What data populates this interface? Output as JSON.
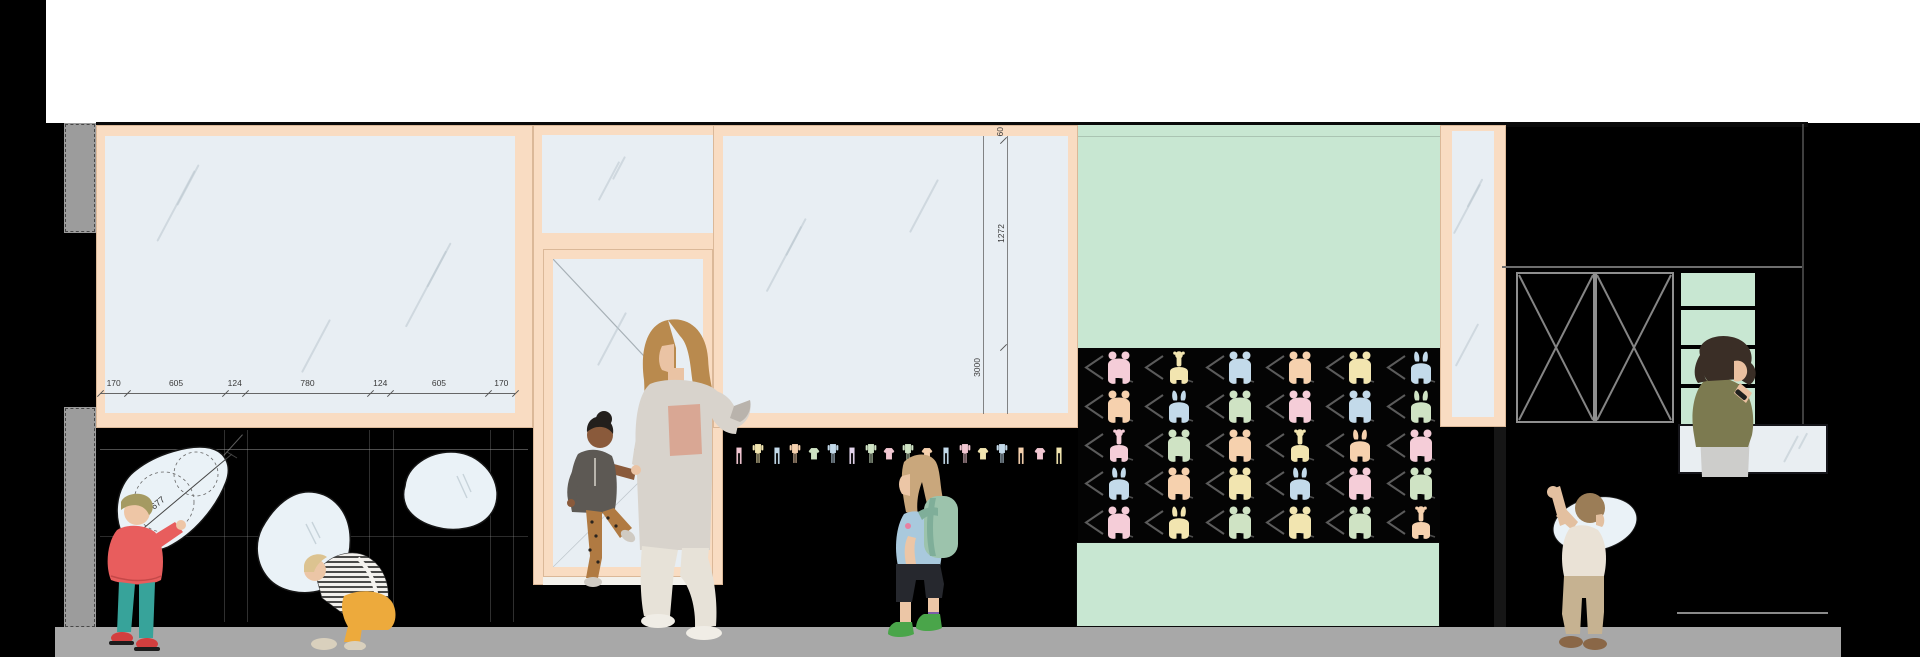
{
  "annotations": {
    "bottom_dims": [
      "170",
      "605",
      "124",
      "780",
      "124",
      "605",
      "170"
    ],
    "blob_dim": "677",
    "vert_dims": [
      "60",
      "1272",
      "3000"
    ]
  },
  "colors": {
    "frame": "#f9dcc2",
    "glass": "#e8eef3",
    "mint": "#c8e7d2",
    "sidewalk": "#a8a8a8",
    "pilaster": "#9c9c9c",
    "mirror": "#eaf2f7",
    "desk": "#e9eef2",
    "wall": "#000000",
    "annotation": "#444444",
    "chevron": "#6b6b6b"
  },
  "pattern_wall": {
    "rows": 5,
    "cols": 6,
    "cells": [
      {
        "c": "#f5cdd8",
        "v": "bear"
      },
      {
        "c": "#f2e5b0",
        "v": "giraffe"
      },
      {
        "c": "#c3daea",
        "v": "bear"
      },
      {
        "c": "#f6d1ae",
        "v": "bear"
      },
      {
        "c": "#f2e5b0",
        "v": "bear"
      },
      {
        "c": "#c3daea",
        "v": "bunny"
      },
      {
        "c": "#f6d1ae",
        "v": "bear"
      },
      {
        "c": "#c3daea",
        "v": "bunny"
      },
      {
        "c": "#cfe3c4",
        "v": "bear"
      },
      {
        "c": "#f5cdd8",
        "v": "bear"
      },
      {
        "c": "#c3daea",
        "v": "bear"
      },
      {
        "c": "#cfe3c4",
        "v": "bunny"
      },
      {
        "c": "#f5cdd8",
        "v": "giraffe"
      },
      {
        "c": "#cfe3c4",
        "v": "bear"
      },
      {
        "c": "#f6d1ae",
        "v": "bear"
      },
      {
        "c": "#f2e5b0",
        "v": "giraffe"
      },
      {
        "c": "#f6d1ae",
        "v": "bunny"
      },
      {
        "c": "#f5cdd8",
        "v": "bear"
      },
      {
        "c": "#c3daea",
        "v": "bunny"
      },
      {
        "c": "#f6d1ae",
        "v": "bear"
      },
      {
        "c": "#f2e5b0",
        "v": "bear"
      },
      {
        "c": "#c3daea",
        "v": "bunny"
      },
      {
        "c": "#f5cdd8",
        "v": "bear"
      },
      {
        "c": "#cfe3c4",
        "v": "bear"
      },
      {
        "c": "#f5cdd8",
        "v": "bear"
      },
      {
        "c": "#f2e5b0",
        "v": "bunny"
      },
      {
        "c": "#cfe3c4",
        "v": "bear"
      },
      {
        "c": "#f2e5b0",
        "v": "bear"
      },
      {
        "c": "#cfe3c4",
        "v": "bear"
      },
      {
        "c": "#f6d1ae",
        "v": "giraffe"
      }
    ]
  },
  "clothes_row": {
    "items": [
      {
        "c": "#f2c7d2",
        "v": "pants"
      },
      {
        "c": "#f2e5b0",
        "v": "romper"
      },
      {
        "c": "#c3daea",
        "v": "pants"
      },
      {
        "c": "#f6d1ae",
        "v": "romper"
      },
      {
        "c": "#cfe3c4",
        "v": "top"
      },
      {
        "c": "#c3daea",
        "v": "romper"
      },
      {
        "c": "#e3d4ec",
        "v": "pants"
      },
      {
        "c": "#cfe3c4",
        "v": "romper"
      },
      {
        "c": "#f2c7d2",
        "v": "top"
      },
      {
        "c": "#cfe3c4",
        "v": "romper"
      },
      {
        "c": "#f6d1ae",
        "v": "top"
      },
      {
        "c": "#c3daea",
        "v": "pants"
      },
      {
        "c": "#f2c7d2",
        "v": "romper"
      },
      {
        "c": "#f2e5b0",
        "v": "top"
      },
      {
        "c": "#c3daea",
        "v": "romper"
      },
      {
        "c": "#f6d1ae",
        "v": "pants"
      },
      {
        "c": "#f2c7d2",
        "v": "top"
      },
      {
        "c": "#f2e5b0",
        "v": "pants"
      }
    ]
  },
  "people": {
    "woman_door": {
      "hair": "#b98a4e",
      "skin": "#eac3a4",
      "cardigan": "#d8d3cc",
      "top": "#d9a794",
      "pants": "#e7e2d8",
      "shoes": "#f0ede6",
      "cuff": "#b9b3ac"
    },
    "child_door": {
      "skin": "#8a5a3b",
      "hair": "#231f1c",
      "tunic": "#5d5954",
      "pants": "#b07a42",
      "shoes": "#cfcac2"
    },
    "toddler_red": {
      "hair": "#a59a62",
      "skin": "#eec6a6",
      "jacket": "#e85d5d",
      "pants": "#37a39a",
      "shoes": "#d23f3f",
      "sole": "#1c1c1c"
    },
    "toddler_crouch": {
      "hair": "#dcc390",
      "skin": "#ecc6a6",
      "pants": "#edaa3c",
      "shoes": "#d9d0bd"
    },
    "girl_backpack": {
      "hair": "#c9a77c",
      "skin": "#ecc6a6",
      "shirt": "#a9c9dd",
      "backpack": "#9cc3ac",
      "strap": "#7fae99",
      "shorts": "#26282e",
      "boots": "#4aa54a",
      "sock": "#7b5ea7",
      "patch": "#e87fa0"
    },
    "woman_desk": {
      "hair": "#3a2e26",
      "skin": "#eac0a0",
      "cardigan": "#7c7a50",
      "skirt": "#cdcdcb",
      "band": "#20201e"
    },
    "toddler_right": {
      "hair": "#9b7d57",
      "skin": "#e3c0a0",
      "shirt": "#eae2d6",
      "pants": "#c6b291",
      "shoes": "#8a6747"
    }
  }
}
